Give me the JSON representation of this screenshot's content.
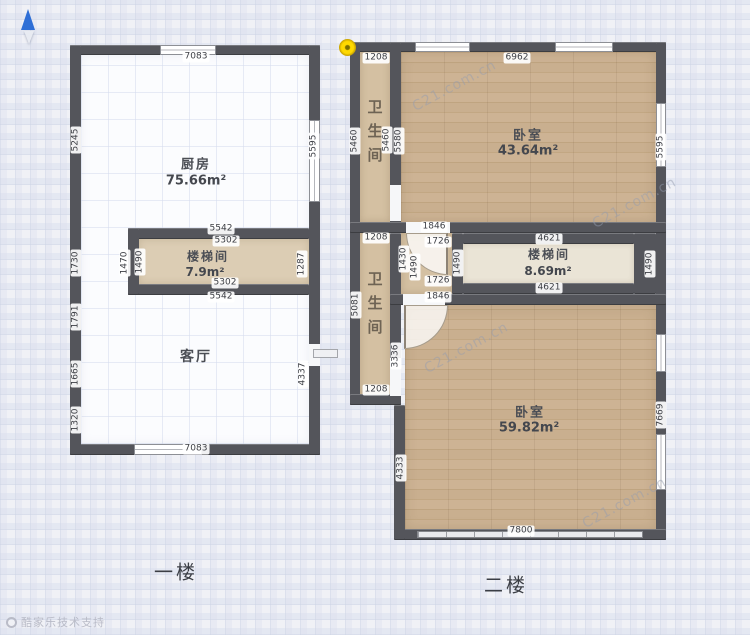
{
  "watermark": {
    "brand": "C21.com.cn",
    "credit": "酷家乐技术支持"
  },
  "icons": {
    "compass": "north-arrow",
    "corner_marker": "yellow-point-marker"
  },
  "colors": {
    "wall": "#54555b",
    "wood": "#c8ae8e",
    "tan": "#d4c0a2",
    "cream": "#eae4d6",
    "marker_yellow": "#ffd900",
    "compass_blue": "#2f6fd6"
  },
  "floor1": {
    "label": "一楼",
    "rooms": {
      "kitchen": {
        "name": "厨房",
        "area": "75.66m²"
      },
      "stairwell": {
        "name": "楼梯间",
        "area": "7.9m²"
      },
      "living": {
        "name": "客厅"
      }
    },
    "dims": {
      "top": "7083",
      "bottom": "7083",
      "left_kitchen": "5245",
      "left_stair": "1730",
      "left_living_a": "1791",
      "left_living_b": "1665",
      "left_living_c": "1320",
      "right_kitchen": "5595",
      "right_stair": "1287",
      "right_living": "4337",
      "stair_outer_top": "5542",
      "stair_inner_top": "5302",
      "stair_inner_bottom": "5302",
      "stair_outer_bottom": "5542",
      "stair_left_outer": "1470",
      "stair_left_inner": "1490"
    }
  },
  "floor2": {
    "label": "二楼",
    "rooms": {
      "bath_top": {
        "name": "卫生间"
      },
      "bedroom_top": {
        "name": "卧室",
        "area": "43.64m²"
      },
      "bath_mid": {
        "name": "卫生间"
      },
      "stairwell": {
        "name": "楼梯间",
        "area": "8.69m²"
      },
      "bedroom_bottom": {
        "name": "卧室",
        "area": "59.82m²"
      }
    },
    "dims": {
      "top_bath": "1208",
      "top_bedroom": "6962",
      "bath_top_left_outer": "5460",
      "bath_top_right_inner": "5460",
      "bedroom_top_left": "5580",
      "bedroom_top_right": "5595",
      "corridor_outer_top": "1846",
      "corridor_inner_top": "1726",
      "corridor_inner_bottom": "1726",
      "corridor_outer_bottom": "1846",
      "corridor_left_a": "1430",
      "corridor_left_b": "1490",
      "corridor_right": "1490",
      "stair_top": "4621",
      "stair_bottom": "4621",
      "stair_right_outer": "1490",
      "bath_mid_top": "1208",
      "bath_mid_left": "5081",
      "bath_mid_bottom": "1208",
      "bath_mid_right_lower": "3336",
      "bedroom_bottom_left": "4333",
      "bedroom_bottom_right": "7669",
      "bedroom_bottom_bottom": "7800"
    }
  }
}
